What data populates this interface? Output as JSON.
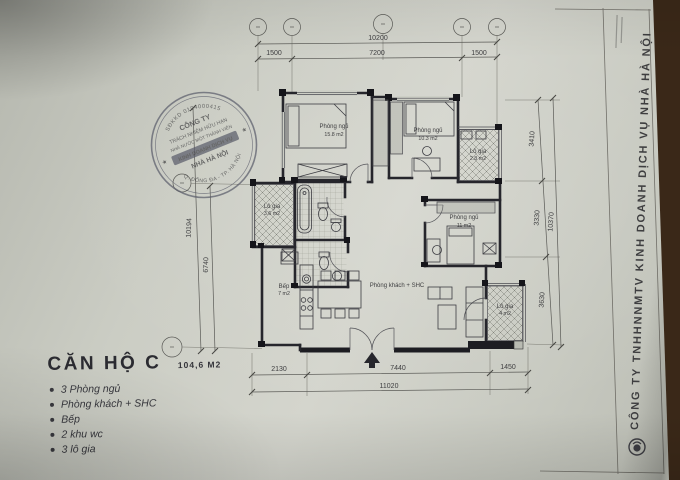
{
  "title_block": {
    "name": "CĂN HỘ C",
    "area": "104,6 M2",
    "features": [
      "3 Phòng ngủ",
      "Phòng khách + SHC",
      "Bếp",
      "2 khu wc",
      "3 lô gia"
    ]
  },
  "rooms": {
    "bedroom_top_left": {
      "name": "Phòng ngủ",
      "area": "15.8 m2"
    },
    "bedroom_top_right": {
      "name": "Phòng ngủ",
      "area": "10.3 m2"
    },
    "bedroom_right": {
      "name": "Phòng ngủ",
      "area": "11 m2"
    },
    "living_room": {
      "name": "Phòng khách + SHC"
    },
    "kitchen": {
      "name": "Bếp",
      "area": "7 m2"
    },
    "loggia_left": {
      "name": "Lô gia",
      "area": "3.6 m2"
    },
    "loggia_top_right": {
      "name": "Lô gia",
      "area": "2.8 m2"
    },
    "loggia_bottom_right": {
      "name": "Lô gia",
      "area": "4 m2"
    }
  },
  "dims": {
    "top_overall": "10200",
    "top_1": "1500",
    "top_2": "7200",
    "top_3": "1500",
    "bottom_1": "2130",
    "bottom_2": "7440",
    "bottom_3": "1450",
    "bottom_overall": "11020",
    "left_outer": "10194",
    "left_inner": "6740",
    "right_1": "3410",
    "right_2": "3330",
    "right_3": "3630",
    "right_overall": "10370"
  },
  "stamp": {
    "line1": "CÔNG TY",
    "line2": "TRÁCH NHIỆM HỮU HẠN",
    "line3": "NHÀ NƯỚC MỘT THÀNH VIÊN",
    "line4": "KINH DOANH DỊCH VỤ",
    "line5": "NHÀ HÀ NỘI",
    "ring_top": "SĐKKD 0104000415",
    "ring_bottom": "Q. ĐỐNG ĐA - TP. HÀ NỘI",
    "star": "★"
  },
  "sidebar": {
    "company": "CÔNG TY TNHHNNMTV KINH DOANH DỊCH VỤ NHÀ HÀ NỘI"
  },
  "colors": {
    "paper": "#cdcfc6",
    "background": "#3a2818",
    "ink": "#3e3e40",
    "stamp_ink": "#5b5d6b"
  }
}
